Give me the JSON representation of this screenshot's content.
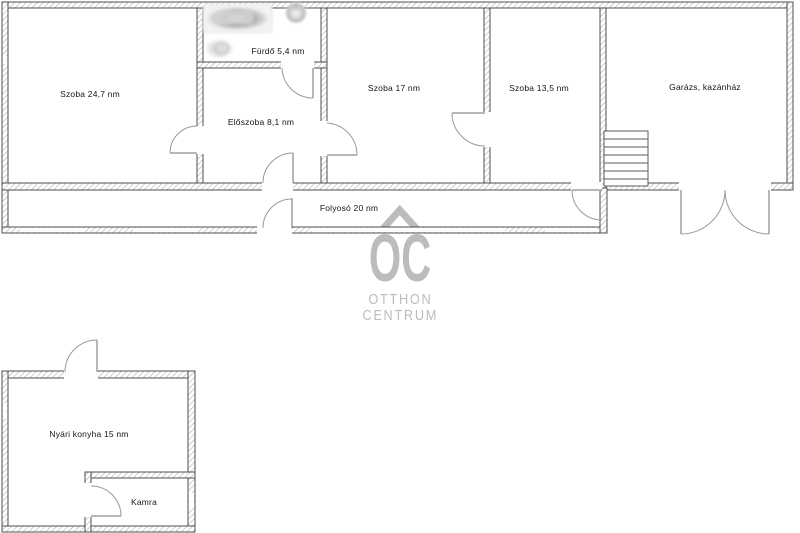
{
  "floorplan": {
    "rooms": [
      {
        "id": "szoba-24-7",
        "label": "Szoba 24,7 nm"
      },
      {
        "id": "furdo",
        "label": "Fürdő 5,4 nm"
      },
      {
        "id": "eloszoba",
        "label": "Előszoba 8,1 nm"
      },
      {
        "id": "szoba-17",
        "label": "Szoba 17 nm"
      },
      {
        "id": "szoba-13-5",
        "label": "Szoba 13,5 nm"
      },
      {
        "id": "garazs",
        "label": "Garázs, kazánház"
      },
      {
        "id": "folyoso",
        "label": "Folyosó 20 nm"
      },
      {
        "id": "nyari-konyha",
        "label": "Nyári konyha 15 nm"
      },
      {
        "id": "kamra",
        "label": "Kamra"
      }
    ],
    "fixtures": [
      "bathtub-icon",
      "washbasin-icon",
      "toilet-icon",
      "stairs"
    ]
  },
  "watermark": {
    "initials": "OC",
    "line1": "OTTHON",
    "line2": "CENTRUM"
  },
  "colors": {
    "background": "#ffffff",
    "wall_outline": "#4f4f4f",
    "wall_hatch": "#aaaaaa",
    "door_arc": "#999999",
    "label_text": "#141414",
    "watermark": "#bcbcbc"
  }
}
